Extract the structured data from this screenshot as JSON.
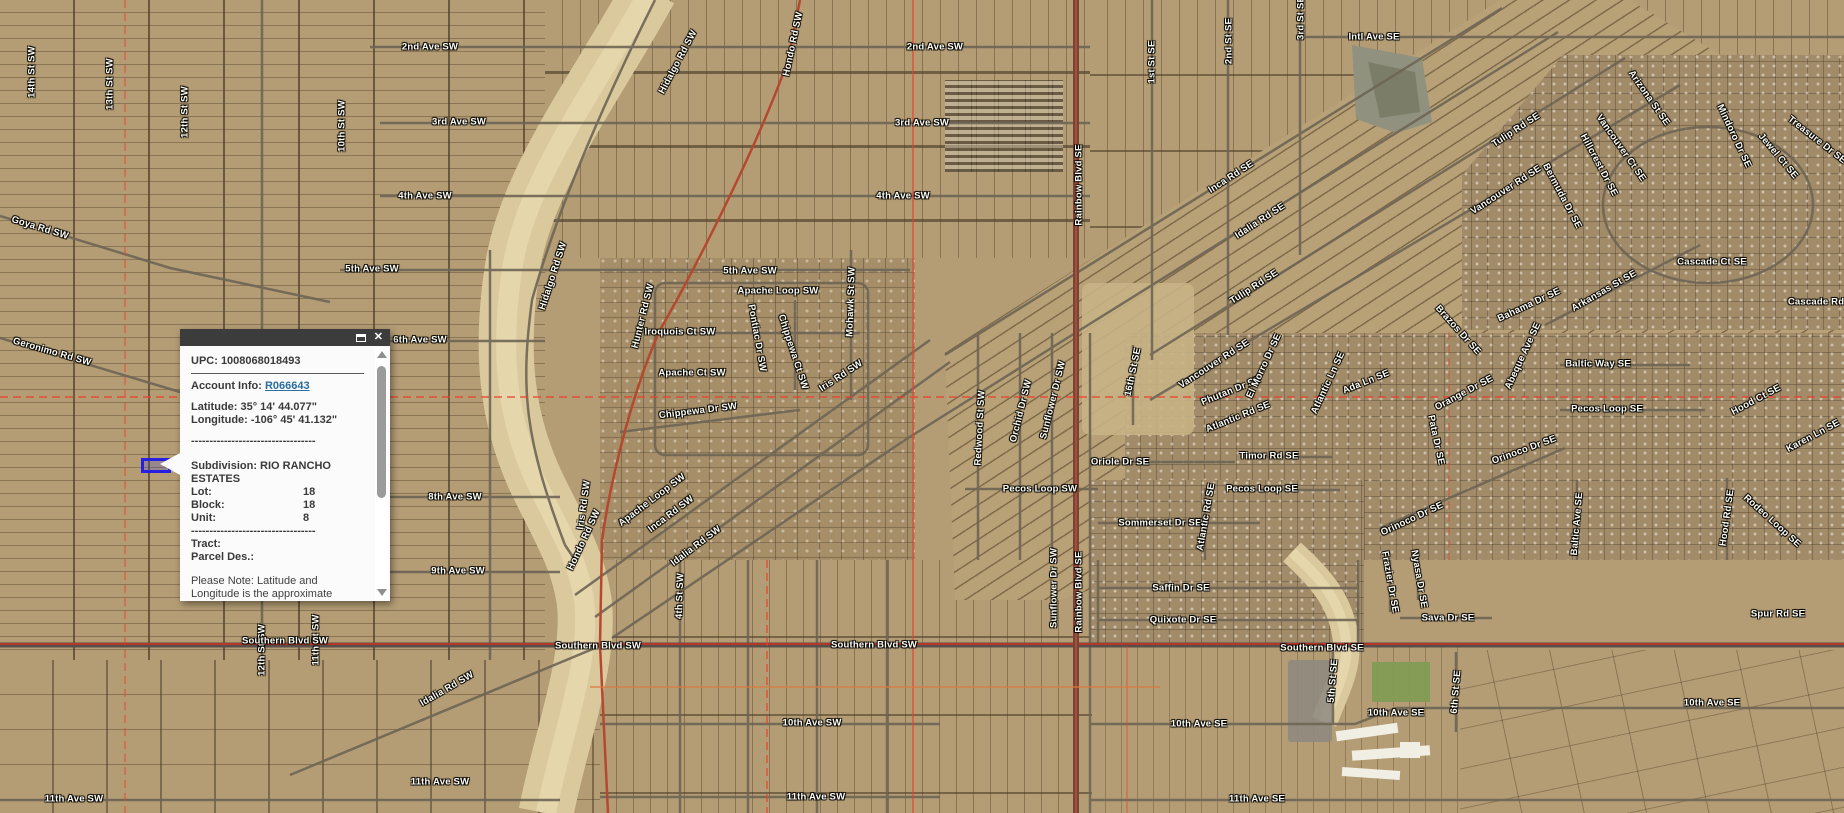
{
  "popup": {
    "upc": "UPC: 1008068018493",
    "account_label": "Account Info: ",
    "account_link": "R066643",
    "latitude": "Latitude: 35° 14' 44.077\"",
    "longitude": "Longitude: -106° 45' 41.132\"",
    "divider": "----------------------------------",
    "subdivision": "Subdivision: RIO RANCHO ESTATES",
    "lot_label": "Lot:",
    "lot_value": "18",
    "block_label": "Block:",
    "block_value": "18",
    "unit_label": "Unit:",
    "unit_value": "8",
    "tract_label": "Tract:",
    "parcel_des_label": "Parcel Des.:",
    "note": "Please Note: Latitude and Longitude is the approximate center of the parcel shown.",
    "title_icons": {
      "close_glyph": "✕"
    }
  },
  "map": {
    "colors": {
      "base": "#b49d75",
      "parcel_line": "#46361f",
      "road_gray": "#6e6555",
      "section_line_red": "#e8432f",
      "road_red": "#b5492f",
      "southern_red": "#c23524",
      "arroyo_sand": "#dbc99e",
      "highlight_blue": "#2720e0"
    },
    "labels": [
      {
        "t": "14th St SW",
        "x": 32,
        "y": 72,
        "r": -90
      },
      {
        "t": "13th St SW",
        "x": 110,
        "y": 84,
        "r": -90
      },
      {
        "t": "12th St SW",
        "x": 185,
        "y": 112,
        "r": -90
      },
      {
        "t": "10th St SW",
        "x": 342,
        "y": 126,
        "r": -90
      },
      {
        "t": "Goya Rd SW",
        "x": 40,
        "y": 228,
        "r": 17
      },
      {
        "t": "Geronimo Rd SW",
        "x": 52,
        "y": 352,
        "r": 16
      },
      {
        "t": "12th St SW",
        "x": 262,
        "y": 650,
        "r": -90
      },
      {
        "t": "11th St SW",
        "x": 316,
        "y": 640,
        "r": -90
      },
      {
        "t": "2nd Ave SW",
        "x": 430,
        "y": 47,
        "r": 0
      },
      {
        "t": "3rd Ave SW",
        "x": 459,
        "y": 122,
        "r": 0
      },
      {
        "t": "4th Ave SW",
        "x": 425,
        "y": 196,
        "r": 0
      },
      {
        "t": "5th Ave SW",
        "x": 372,
        "y": 269,
        "r": 0
      },
      {
        "t": "6th Ave SW",
        "x": 420,
        "y": 340,
        "r": 0
      },
      {
        "t": "8th Ave SW",
        "x": 455,
        "y": 497,
        "r": 0
      },
      {
        "t": "9th Ave SW",
        "x": 458,
        "y": 571,
        "r": 0
      },
      {
        "t": "11th Ave SW",
        "x": 74,
        "y": 799,
        "r": 0
      },
      {
        "t": "11th Ave SW",
        "x": 440,
        "y": 782,
        "r": 0
      },
      {
        "t": "Southern Blvd SW",
        "x": 285,
        "y": 641,
        "r": 0
      },
      {
        "t": "Southern Blvd SW",
        "x": 598,
        "y": 646,
        "r": 0
      },
      {
        "t": "Southern Blvd SW",
        "x": 874,
        "y": 645,
        "r": 0
      },
      {
        "t": "Hidalgo Rd SW",
        "x": 678,
        "y": 62,
        "r": -62
      },
      {
        "t": "Hidalgo Rd SW",
        "x": 553,
        "y": 276,
        "r": -72
      },
      {
        "t": "Hondo Rd SW",
        "x": 793,
        "y": 44,
        "r": -78
      },
      {
        "t": "Hondo Rd SW",
        "x": 584,
        "y": 540,
        "r": -65
      },
      {
        "t": "2nd Ave SW",
        "x": 935,
        "y": 47,
        "r": 0
      },
      {
        "t": "3rd Ave SW",
        "x": 922,
        "y": 123,
        "r": 0
      },
      {
        "t": "4th Ave SW",
        "x": 903,
        "y": 196,
        "r": 0
      },
      {
        "t": "5th Ave SW",
        "x": 750,
        "y": 271,
        "r": 0
      },
      {
        "t": "Hunter Rd SW",
        "x": 643,
        "y": 316,
        "r": -76
      },
      {
        "t": "Apache Loop SW",
        "x": 778,
        "y": 291,
        "r": 0
      },
      {
        "t": "Iroquois Ct SW",
        "x": 680,
        "y": 332,
        "r": 0
      },
      {
        "t": "Pontiac Dr SW",
        "x": 757,
        "y": 338,
        "r": 80
      },
      {
        "t": "Chippewa Ct SW",
        "x": 793,
        "y": 352,
        "r": 72
      },
      {
        "t": "Apache Ct SW",
        "x": 692,
        "y": 373,
        "r": 0
      },
      {
        "t": "Chippewa Dr SW",
        "x": 698,
        "y": 411,
        "r": -7
      },
      {
        "t": "Mohawk St SW",
        "x": 851,
        "y": 302,
        "r": -88
      },
      {
        "t": "Iris Rd SW",
        "x": 841,
        "y": 376,
        "r": -33
      },
      {
        "t": "Apache Loop SW",
        "x": 652,
        "y": 500,
        "r": -37
      },
      {
        "t": "Inca Rd SW",
        "x": 671,
        "y": 514,
        "r": -37
      },
      {
        "t": "Idalia Rd SW",
        "x": 696,
        "y": 546,
        "r": -37
      },
      {
        "t": "Iris Rd SW",
        "x": 584,
        "y": 505,
        "r": -82
      },
      {
        "t": "4th St SW",
        "x": 680,
        "y": 596,
        "r": -88
      },
      {
        "t": "Idalia Rd SW",
        "x": 447,
        "y": 689,
        "r": -30
      },
      {
        "t": "10th Ave SW",
        "x": 812,
        "y": 723,
        "r": 0
      },
      {
        "t": "11th Ave SW",
        "x": 816,
        "y": 797,
        "r": 0
      },
      {
        "t": "Rainbow Blvd SE",
        "x": 1079,
        "y": 185,
        "r": -90
      },
      {
        "t": "Rainbow Blvd SE",
        "x": 1079,
        "y": 592,
        "r": -90
      },
      {
        "t": "Sunflower Dr SW",
        "x": 1054,
        "y": 588,
        "r": -90
      },
      {
        "t": "1st St SE",
        "x": 1152,
        "y": 62,
        "r": -90
      },
      {
        "t": "2nd St SE",
        "x": 1229,
        "y": 41,
        "r": -90
      },
      {
        "t": "3rd St SE",
        "x": 1301,
        "y": 18,
        "r": -90
      },
      {
        "t": "Intl Ave SE",
        "x": 1374,
        "y": 37,
        "r": 0
      },
      {
        "t": "Inca Rd SE",
        "x": 1231,
        "y": 177,
        "r": -33
      },
      {
        "t": "Idalia Rd SE",
        "x": 1260,
        "y": 221,
        "r": -33
      },
      {
        "t": "Tulip Rd SE",
        "x": 1254,
        "y": 287,
        "r": -33
      },
      {
        "t": "Tulip Rd SE",
        "x": 1516,
        "y": 130,
        "r": -33
      },
      {
        "t": "Vancouver Rd SE",
        "x": 1506,
        "y": 190,
        "r": -33
      },
      {
        "t": "Vancouver Rd SE",
        "x": 1214,
        "y": 364,
        "r": -33
      },
      {
        "t": "16th St SE",
        "x": 1133,
        "y": 372,
        "r": -78
      },
      {
        "t": "Phutan Dr SE",
        "x": 1231,
        "y": 391,
        "r": -22
      },
      {
        "t": "Atlantic Rd SE",
        "x": 1238,
        "y": 417,
        "r": -22
      },
      {
        "t": "El Morro Dr SE",
        "x": 1264,
        "y": 366,
        "r": -65
      },
      {
        "t": "Atlantic Ln SE",
        "x": 1328,
        "y": 383,
        "r": -65
      },
      {
        "t": "Ada Ln SE",
        "x": 1366,
        "y": 382,
        "r": -22
      },
      {
        "t": "Brazos Dr SE",
        "x": 1458,
        "y": 330,
        "r": 48
      },
      {
        "t": "Orange Dr SE",
        "x": 1464,
        "y": 393,
        "r": -28
      },
      {
        "t": "Pata Dr SE",
        "x": 1436,
        "y": 440,
        "r": 78
      },
      {
        "t": "Orinoco Dr SE",
        "x": 1524,
        "y": 450,
        "r": -20
      },
      {
        "t": "Orinoco Dr SE",
        "x": 1412,
        "y": 519,
        "r": -25
      },
      {
        "t": "Timor Rd SE",
        "x": 1269,
        "y": 456,
        "r": 0
      },
      {
        "t": "Pecos Loop SE",
        "x": 1262,
        "y": 489,
        "r": 0
      },
      {
        "t": "Pecos Loop SE",
        "x": 1607,
        "y": 409,
        "r": 0
      },
      {
        "t": "Baltic Way SE",
        "x": 1598,
        "y": 364,
        "r": 0
      },
      {
        "t": "Abeque Ave SE",
        "x": 1523,
        "y": 356,
        "r": -65
      },
      {
        "t": "Baltic Ave SE",
        "x": 1577,
        "y": 524,
        "r": -85
      },
      {
        "t": "Hood Ct SE",
        "x": 1756,
        "y": 400,
        "r": -28
      },
      {
        "t": "Karen Ln SE",
        "x": 1813,
        "y": 436,
        "r": -28
      },
      {
        "t": "Hood Rd SE",
        "x": 1727,
        "y": 518,
        "r": -82
      },
      {
        "t": "Rodeo Loop SE",
        "x": 1772,
        "y": 521,
        "r": 42
      },
      {
        "t": "Arizona St SE",
        "x": 1649,
        "y": 98,
        "r": 55
      },
      {
        "t": "Vancouver Ct SE",
        "x": 1621,
        "y": 148,
        "r": 55
      },
      {
        "t": "Hillcrest Dr SE",
        "x": 1599,
        "y": 165,
        "r": 62
      },
      {
        "t": "Bermuda Dr SE",
        "x": 1562,
        "y": 196,
        "r": 62
      },
      {
        "t": "Mindoro Dr SE",
        "x": 1734,
        "y": 136,
        "r": 65
      },
      {
        "t": "Jewel Ct SE",
        "x": 1778,
        "y": 156,
        "r": 50
      },
      {
        "t": "Treasure Dr SE",
        "x": 1817,
        "y": 140,
        "r": 38
      },
      {
        "t": "Cascade Ct SE",
        "x": 1712,
        "y": 262,
        "r": 0
      },
      {
        "t": "Arkansas St SE",
        "x": 1604,
        "y": 291,
        "r": -30
      },
      {
        "t": "Bahama Dr SE",
        "x": 1529,
        "y": 305,
        "r": -25
      },
      {
        "t": "Cascade Rd SE",
        "x": 1824,
        "y": 302,
        "r": 0
      },
      {
        "t": "Redwood St SW",
        "x": 980,
        "y": 428,
        "r": -87
      },
      {
        "t": "Orchid Dr SW",
        "x": 1021,
        "y": 411,
        "r": -76
      },
      {
        "t": "Sunflower Dr SW",
        "x": 1053,
        "y": 400,
        "r": -76
      },
      {
        "t": "Pecos Loop SW",
        "x": 1040,
        "y": 489,
        "r": 0
      },
      {
        "t": "Oriole Dr SE",
        "x": 1120,
        "y": 462,
        "r": 0
      },
      {
        "t": "Sommerset Dr SE",
        "x": 1160,
        "y": 523,
        "r": 0
      },
      {
        "t": "Atlantic Rd SE",
        "x": 1206,
        "y": 517,
        "r": -80
      },
      {
        "t": "Saffin Dr SE",
        "x": 1181,
        "y": 588,
        "r": 0
      },
      {
        "t": "Quixote Dr SE",
        "x": 1183,
        "y": 620,
        "r": 0
      },
      {
        "t": "Southern Blvd SE",
        "x": 1322,
        "y": 648,
        "r": 0
      },
      {
        "t": "5th St SE",
        "x": 1333,
        "y": 681,
        "r": -85
      },
      {
        "t": "10th Ave SE",
        "x": 1199,
        "y": 724,
        "r": 0
      },
      {
        "t": "10th Ave SE",
        "x": 1396,
        "y": 713,
        "r": 0
      },
      {
        "t": "10th Ave SE",
        "x": 1712,
        "y": 703,
        "r": 0
      },
      {
        "t": "6th St SE",
        "x": 1456,
        "y": 692,
        "r": -85
      },
      {
        "t": "11th Ave SE",
        "x": 1257,
        "y": 799,
        "r": 0
      },
      {
        "t": "Frazier Dr SE",
        "x": 1390,
        "y": 582,
        "r": 80
      },
      {
        "t": "Nyasa Dr SE",
        "x": 1419,
        "y": 579,
        "r": 80
      },
      {
        "t": "Sava Dr SE",
        "x": 1448,
        "y": 618,
        "r": 0
      },
      {
        "t": "Spur Rd SE",
        "x": 1778,
        "y": 614,
        "r": 0
      }
    ]
  }
}
